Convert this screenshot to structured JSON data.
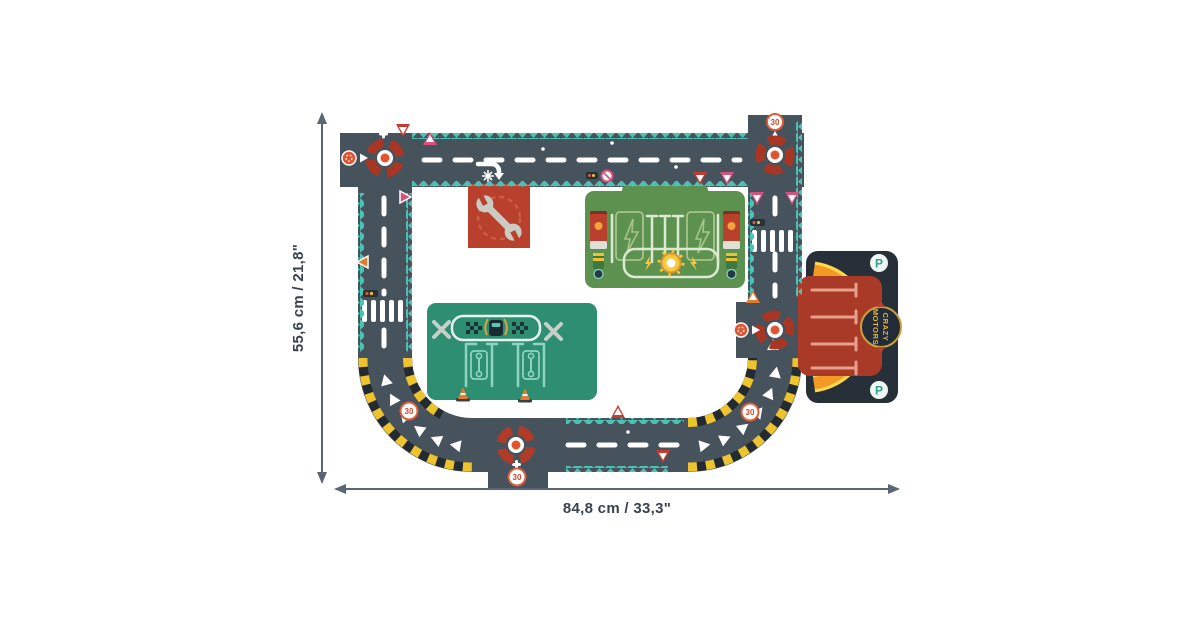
{
  "diagram": {
    "type": "toy-road-track product dimension diagram",
    "background": "#ffffff",
    "dimensions": {
      "height_label": "55,6 cm / 21,8\"",
      "width_label": "84,8 cm / 33,3\""
    },
    "labels": {
      "speed_limit": "30",
      "parking": "P",
      "brand_line1": "CRAZY",
      "brand_line2": "MOTORS"
    },
    "icons": [
      "roundabout-icon",
      "wrench-icon",
      "traffic-light-icon",
      "yield-sign-icon",
      "warning-sign-icon",
      "speed-30-sign-icon",
      "charging-pump-icon",
      "traffic-cone-icon",
      "parking-sign-icon",
      "checkered-flag-icon",
      "sun-logo-icon"
    ],
    "colors": {
      "road": "#46535d",
      "puzzle_edge_teal": "#4ec1b5",
      "hazard_yellow": "#edc32e",
      "hazard_dark": "#232a32",
      "roundabout_ring_red": "#a93523",
      "roundabout_dot": "#e2542f",
      "garage_sign_red": "#b8402c",
      "wrench_silver": "#c9cbc4",
      "charging_station_green": "#5c9150",
      "pit_stop_green": "#2d8e72",
      "parking_base_dark": "#273039",
      "parking_red": "#a93a28",
      "parking_arc_orange": "#f29a23",
      "parking_arc_yellow": "#ffd84d",
      "parking_line_salmon": "#e8a08c",
      "pink_sign": "#d6527c",
      "orange_sign": "#e07c2c",
      "dimension_line": "#5a6575",
      "dimension_text": "#39424e"
    }
  }
}
